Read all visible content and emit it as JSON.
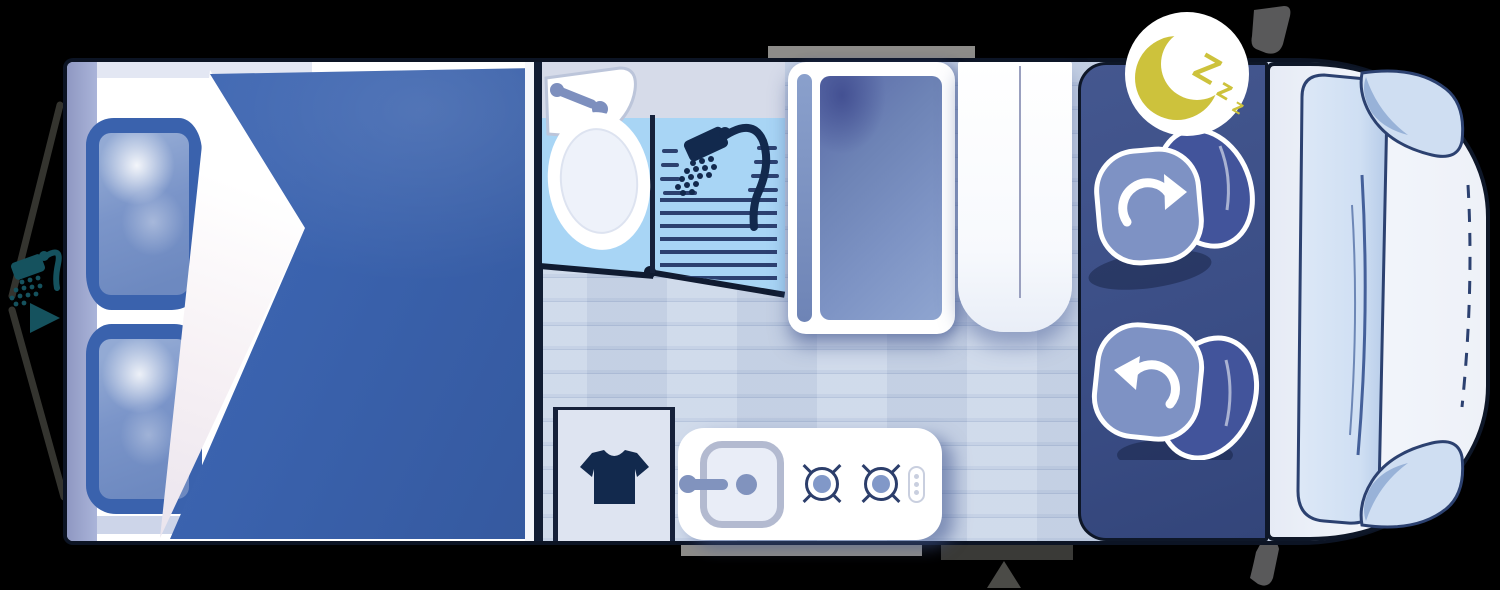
{
  "scene": {
    "type": "campervan-night-floorplan",
    "background_color": "#000000"
  },
  "badges": {
    "night_mode": {
      "icon": "moon-icon",
      "chars": [
        "Z",
        "z",
        "z"
      ],
      "badge_color": "#ffffff",
      "moon_color": "#cdc23c"
    }
  },
  "exterior": {
    "outdoor_shower_icon": "shower-head-icon",
    "outdoor_shower_color": "#15525e",
    "rear_marker_icon": "right-triangle-icon",
    "entry_marker_icon": "up-triangle-icon",
    "entry_marker_color": "#4b4b47",
    "entry_step_color": "#8d8c89",
    "top_window_color": "#8d8c89",
    "mirror_color": "#59595a"
  },
  "interior": {
    "bedroom": {
      "duvet_color": "#3a62ad",
      "pillow_count": 2,
      "pillow_color": "#3a62ad",
      "mattress_color": "#ffffff",
      "headboard_color": "#aab4d9"
    },
    "bathroom": {
      "floor_color": "#a6d4f4",
      "fixtures": [
        "washbasin",
        "toilet",
        "shower"
      ],
      "shower_icon": "shower-head-icon",
      "icon_color": "#12294d"
    },
    "wardrobe": {
      "door_color": "#7d93c4"
    },
    "cabinet": {
      "color": "#ffffff"
    },
    "closet": {
      "icon": "tshirt-icon",
      "icon_color": "#12294d"
    },
    "kitchen": {
      "counter_color": "#ffffff",
      "fixtures": [
        "sink",
        "faucet",
        "burner",
        "burner",
        "control-panel"
      ],
      "burner_color": "#2c3e6b"
    },
    "hall_floor_color": "#c9d4e8",
    "cab": {
      "panel_color": "#3a4d85",
      "seats": [
        {
          "name": "driver-seat",
          "rotate_icon": "rotate-cw-icon"
        },
        {
          "name": "passenger-seat",
          "rotate_icon": "rotate-ccw-icon"
        }
      ],
      "seat_color": "#7e92c4",
      "backrest_color": "#42549b"
    },
    "cab_front": {
      "body_color": "#eef1f8",
      "windshield_color": "#d7e3f5",
      "window_frame_color": "#2c4170"
    }
  }
}
